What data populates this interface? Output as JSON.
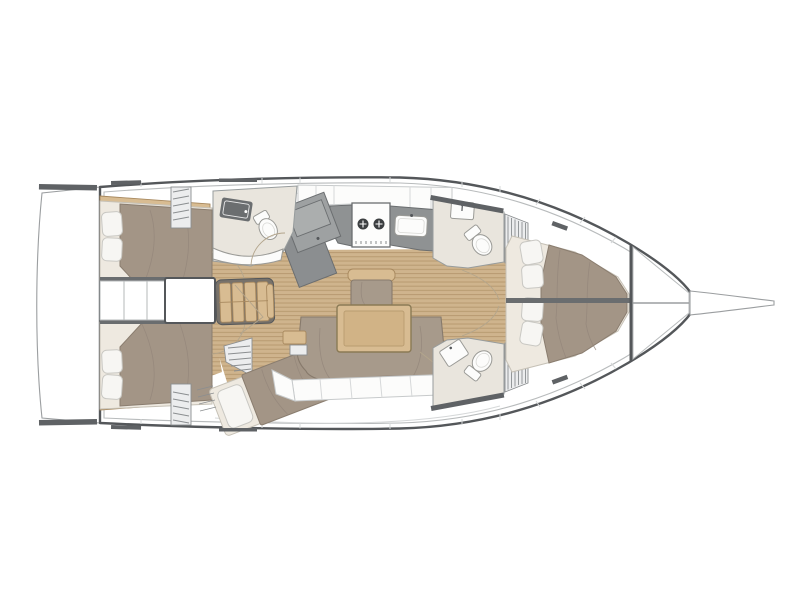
{
  "diagram": {
    "type": "yacht-interior-floor-plan",
    "orientation": "bow-right",
    "rooms": [
      "aft-cabin-port",
      "aft-cabin-starboard",
      "companionway",
      "settee",
      "salon",
      "galley",
      "nav-station",
      "aft-head",
      "mid-cabin",
      "forward-head-starboard",
      "forward-head-port",
      "forward-cabin-starboard",
      "forward-cabin-port",
      "anchor-locker",
      "swim-platform",
      "bowsprit"
    ],
    "fixtures": [
      "double-berth",
      "pillows",
      "stove-2-burner",
      "galley-sink",
      "chart-table",
      "toilet",
      "washbasin",
      "salon-table",
      "u-shaped-sofa",
      "chair",
      "steps"
    ]
  },
  "palette": {
    "background": "#ffffff",
    "hull_outline": "#54575a",
    "hull_inner": "#b8bbbc",
    "panel_seam": "#d6d8d9",
    "platform_edge": "#9b9ea0",
    "hatch": "#5f6265",
    "floor": "#cfb48d",
    "floor_line": "#b5976e",
    "wood": "#d8bc92",
    "wood_edge": "#a8895f",
    "duvet": "#a39586",
    "duvet_edge": "#8a7d6f",
    "duvet_fold": "#93867a",
    "mattress": "#eee9e0",
    "mattress_edge": "#c6c1b6",
    "pillow": "#f7f6f3",
    "pillow_edge": "#c9c8c3",
    "counter": "#8f9293",
    "counter_edge": "#6b6e70",
    "nav_low": "#8b8e90",
    "nav_high": "#9ea1a2",
    "nav_panel": "#abaeae",
    "stove": "#fdfdfc",
    "burner": "#3c3f41",
    "head_floor": "#e9e5dd",
    "head_edge": "#979c9d",
    "fixture": "#fcfcfb",
    "fixture_edge": "#9a9a96",
    "sink_dark": "#6b6e70",
    "sofa": "#a79a8b",
    "sofa_edge": "#877a6c",
    "locker": "#fcfcfb",
    "locker_edge": "#c7cacb",
    "wall_dark": "#6a6d6f",
    "corridor_edge": "#b5b8ba",
    "arc": "#b3a58c",
    "louver": "#8b8e90",
    "steps": "#ecedee",
    "steps_edge": "#8b8e90",
    "settee_base": "#78726a"
  }
}
